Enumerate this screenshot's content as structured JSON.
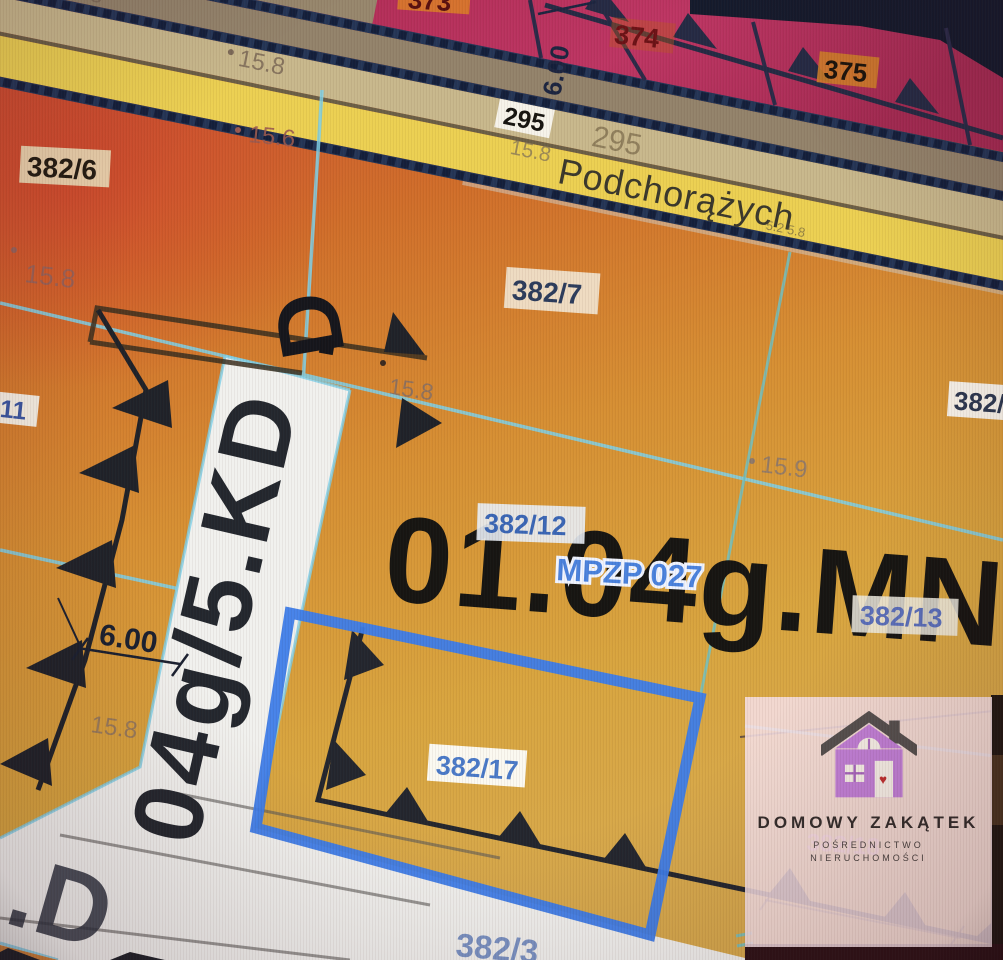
{
  "street": {
    "name": "Podchorążych"
  },
  "plan": {
    "ref": "MPZP 027"
  },
  "zones": {
    "main": "01.04g.MN",
    "road_vertical": "04g/5.KD",
    "road_bottom_left": ".D",
    "road_glyph_top": "D"
  },
  "parcels": {
    "p373": "373",
    "p374": "374",
    "p375": "375",
    "p295_chip": "295",
    "p295_gray": "295",
    "p382_6": "382/6",
    "p382_7": "382/7",
    "p382_11": "11",
    "p382_12": "382/12",
    "p382_13": "382/13",
    "p382_17": "382/17",
    "p382_3": "382/3",
    "p382_right": "382/",
    "p382_18_faint": "382/18"
  },
  "elevations": {
    "top_left": "15.8",
    "top_mid": "15.8",
    "top_mid2": "15.6",
    "road_tan": "15.8",
    "left_red": "15.8",
    "center": "15.8",
    "center_right": "15.9",
    "lower_left": "15.8",
    "yellow_marks": "5.2  5.8"
  },
  "dimensions": {
    "road_width_top": "6.00",
    "road_width_left": "6.00"
  },
  "watermark": {
    "brand": "DOMOWY ZAKĄTEK",
    "sub1": "POŚREDNICTWO",
    "sub2": "NIERUCHOMOŚCI"
  },
  "colors": {
    "selected_parcel_blue": "#3d7ce8",
    "cadastral_cyan": "#7fd0e8",
    "zone_magenta": "#b53260",
    "chain_navy": "#243556",
    "street_yellow": "#ecd052",
    "zone_red": "#c84a35",
    "zone_gold": "#d7a94c",
    "panel_pink": "#f4dee3",
    "house_purple": "#c17fd5"
  }
}
